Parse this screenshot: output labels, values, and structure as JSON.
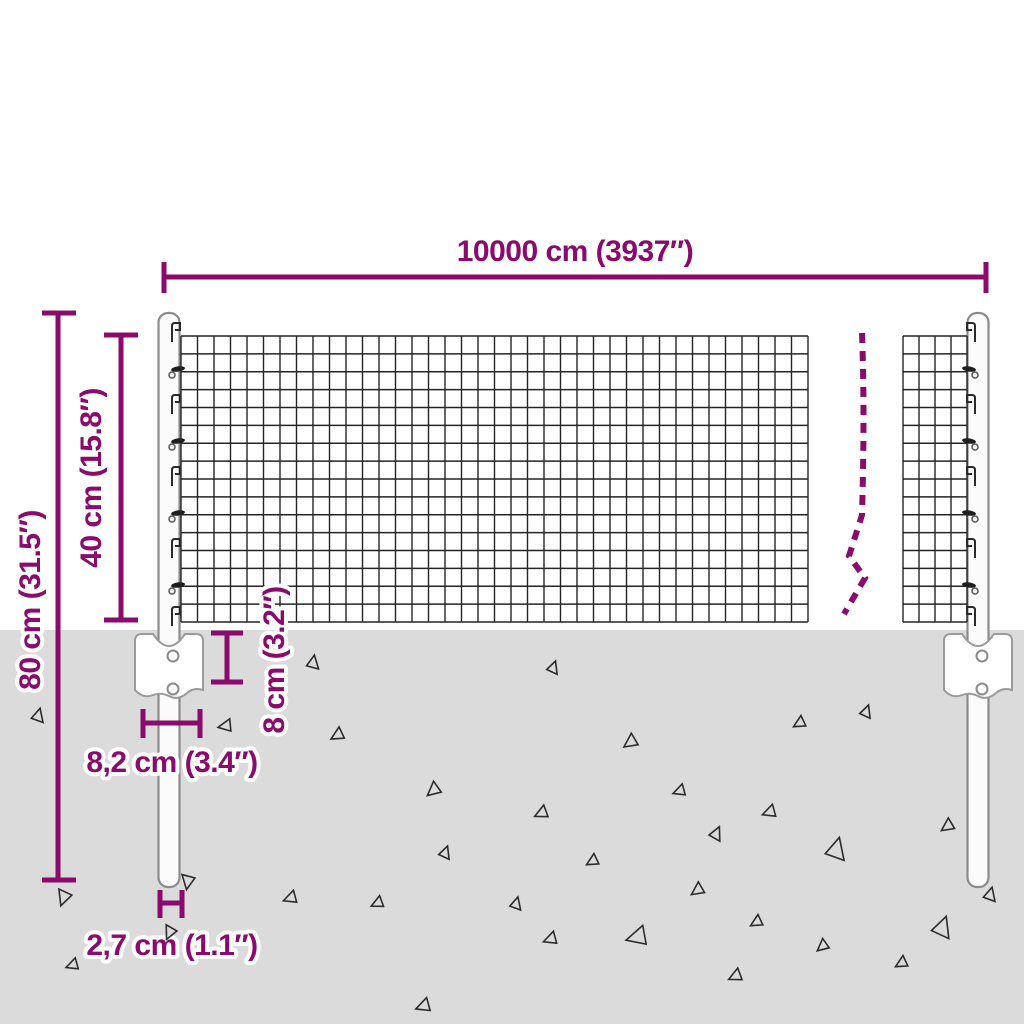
{
  "diagram_type": "product-dimension-diagram",
  "product": "wire mesh fence with ground anchor posts",
  "colors": {
    "accent": "#8A0B6B",
    "ground": "#DBDBDB",
    "mesh": "#242424",
    "post_outline": "#8B8B8B",
    "background": "#FFFFFF"
  },
  "labels": {
    "total_width": "10000 cm (3937″)",
    "total_height": "80 cm (31.5″)",
    "mesh_height": "40 cm (15.8″)",
    "anchor_depth": "8 cm (3.2″)",
    "anchor_width": "8,2 cm (3.4″)",
    "post_diameter": "2,7 cm (1.1″)"
  },
  "fence": {
    "mesh_sections": [
      {
        "x0": 181,
        "x1": 808,
        "y0": 336,
        "y1": 622,
        "cols": 38,
        "rows": 16
      },
      {
        "x0": 903,
        "x1": 967,
        "y0": 336,
        "y1": 622,
        "cols": 4,
        "rows": 16
      }
    ],
    "posts": [
      {
        "cx": 169,
        "side": 1
      },
      {
        "cx": 978,
        "side": -1
      }
    ],
    "hook_rows": [
      333,
      369,
      405,
      441,
      477,
      513,
      549,
      585,
      617
    ]
  },
  "break_line": {
    "path": "M862,333 C864,390 864,440 862,515 L849,556 L865,578 L844,614"
  },
  "ground": {
    "level_y": 630,
    "debris": [
      [
        38,
        716,
        13,
        15
      ],
      [
        64,
        897,
        15,
        200
      ],
      [
        73,
        965,
        12,
        250
      ],
      [
        188,
        881,
        14,
        190
      ],
      [
        226,
        726,
        13,
        260
      ],
      [
        291,
        898,
        13,
        250
      ],
      [
        313,
        663,
        13,
        10
      ],
      [
        338,
        735,
        13,
        240
      ],
      [
        378,
        903,
        12,
        245
      ],
      [
        424,
        1006,
        14,
        250
      ],
      [
        434,
        790,
        14,
        230
      ],
      [
        445,
        853,
        12,
        20
      ],
      [
        516,
        904,
        12,
        15
      ],
      [
        542,
        813,
        13,
        245
      ],
      [
        551,
        939,
        13,
        250
      ],
      [
        553,
        668,
        12,
        20
      ],
      [
        593,
        861,
        12,
        240
      ],
      [
        631,
        742,
        14,
        235
      ],
      [
        638,
        937,
        20,
        255
      ],
      [
        680,
        791,
        12,
        250
      ],
      [
        698,
        890,
        13,
        235
      ],
      [
        716,
        834,
        13,
        25
      ],
      [
        736,
        976,
        13,
        245
      ],
      [
        757,
        922,
        12,
        240
      ],
      [
        770,
        812,
        13,
        250
      ],
      [
        800,
        723,
        12,
        240
      ],
      [
        823,
        946,
        12,
        230
      ],
      [
        836,
        850,
        21,
        15
      ],
      [
        866,
        712,
        12,
        20
      ],
      [
        902,
        963,
        12,
        240
      ],
      [
        942,
        928,
        20,
        20
      ],
      [
        948,
        826,
        13,
        235
      ],
      [
        990,
        895,
        13,
        15
      ]
    ],
    "debris_top": [
      [
        170,
        932,
        13,
        205
      ]
    ]
  }
}
